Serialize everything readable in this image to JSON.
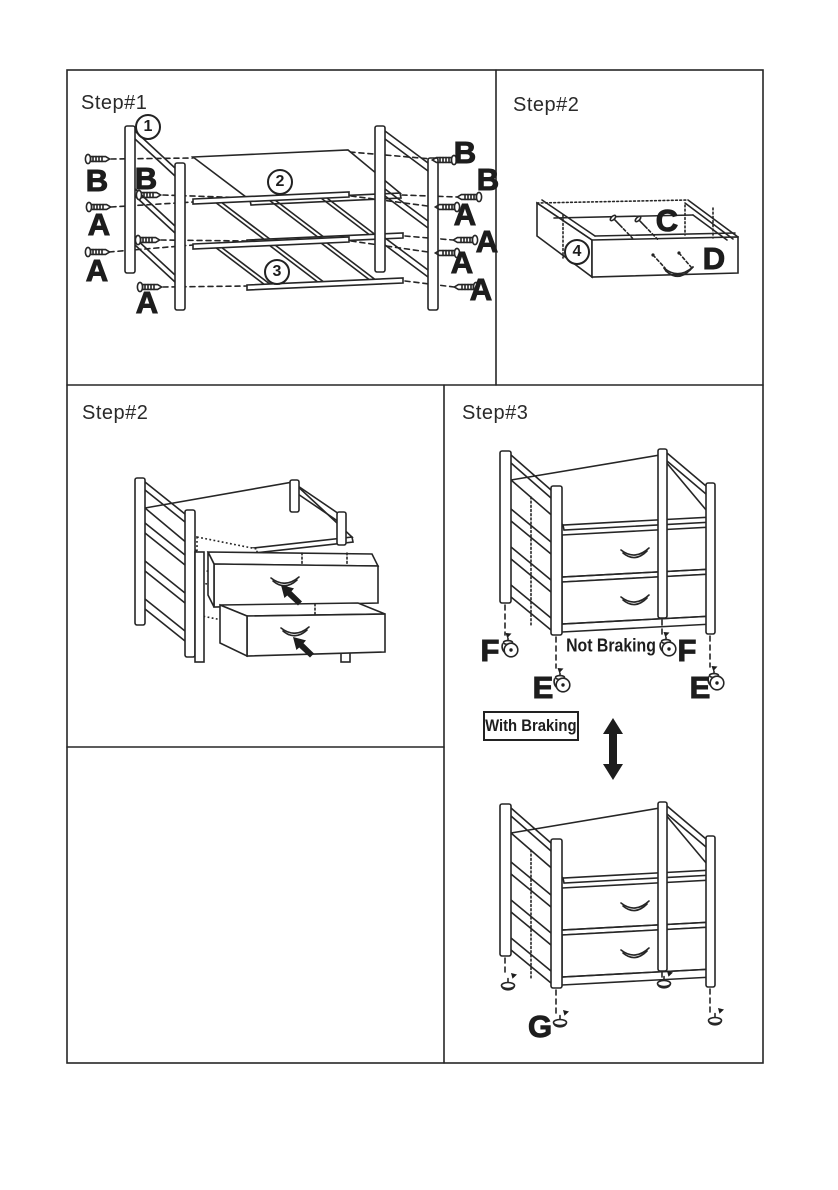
{
  "colors": {
    "line": "#262626",
    "paper": "#ffffff"
  },
  "step1": {
    "title": "Step#1",
    "part_frame": "1",
    "part_shelf": "2",
    "part_rack": "3",
    "screws_left": [
      "B",
      "B",
      "A",
      "A",
      "A"
    ],
    "screws_right": [
      "B",
      "B",
      "A",
      "A",
      "A",
      "A"
    ]
  },
  "step2_drawer": {
    "title": "Step#2",
    "part_drawer": "4",
    "screw_label": "C",
    "handle_label": "D"
  },
  "step2_insert": {
    "title": "Step#2"
  },
  "step3": {
    "title": "Step#3",
    "not_braking": "Not Braking",
    "with_braking": "With Braking",
    "f_labels": [
      "F",
      "F"
    ],
    "e_labels": [
      "E",
      "E"
    ],
    "g_label": "G"
  }
}
